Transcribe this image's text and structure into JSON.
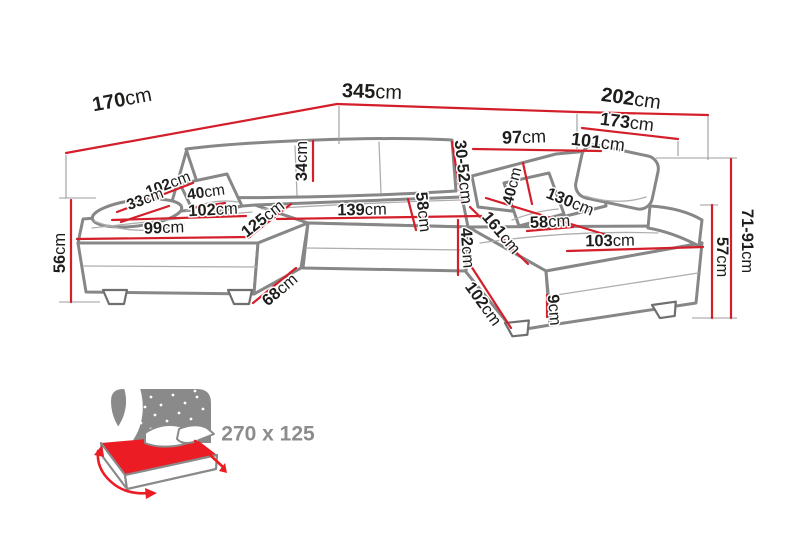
{
  "colors": {
    "dimension_red": "#d41e2a",
    "outline_gray": "#878787",
    "label_color": "#1d1d1b",
    "icon_gray": "#8c8c8c",
    "bed_mattress_red": "#ec1c24"
  },
  "diagram": {
    "measurements": {
      "left_depth": {
        "v": "170",
        "u": "cm"
      },
      "back_width": {
        "v": "345",
        "u": "cm"
      },
      "right_depth": {
        "v": "202",
        "u": "cm"
      },
      "right_back_length": {
        "v": "173",
        "u": "cm"
      },
      "back_segment_left": {
        "v": "97",
        "u": "cm"
      },
      "back_segment_right": {
        "v": "101",
        "u": "cm"
      },
      "backrest_height": {
        "v": "34",
        "u": "cm"
      },
      "headrest_range": {
        "v": "30-52",
        "u": "cm"
      },
      "left_arm_length": {
        "v": "102",
        "u": "cm"
      },
      "left_arm_width": {
        "v": "33",
        "u": "cm"
      },
      "left_pillow_width": {
        "v": "40",
        "u": "cm"
      },
      "left_seat_length": {
        "v": "102",
        "u": "cm"
      },
      "left_seat_width": {
        "v": "99",
        "u": "cm"
      },
      "left_chaise_depth": {
        "v": "125",
        "u": "cm"
      },
      "mid_seat_width": {
        "v": "139",
        "u": "cm"
      },
      "mid_seat_depth": {
        "v": "58",
        "u": "cm"
      },
      "seat_height_front": {
        "v": "42",
        "u": "cm"
      },
      "left_total_height": {
        "v": "56",
        "u": "cm"
      },
      "front_edge_depth": {
        "v": "68",
        "u": "cm"
      },
      "right_pillow_width": {
        "v": "40",
        "u": "cm"
      },
      "right_seat_depth": {
        "v": "58",
        "u": "cm"
      },
      "right_backrest_width": {
        "v": "130",
        "u": "cm"
      },
      "right_seat_length": {
        "v": "103",
        "u": "cm"
      },
      "right_chaise_length": {
        "v": "161",
        "u": "cm"
      },
      "right_chaise_side": {
        "v": "102",
        "u": "cm"
      },
      "step_height": {
        "v": "9",
        "u": "cm"
      },
      "right_seat_height": {
        "v": "57",
        "u": "cm"
      },
      "total_height_range": {
        "v": "71-91",
        "u": "cm"
      }
    },
    "sleeping_area": {
      "size_label": "270 x 125"
    }
  }
}
